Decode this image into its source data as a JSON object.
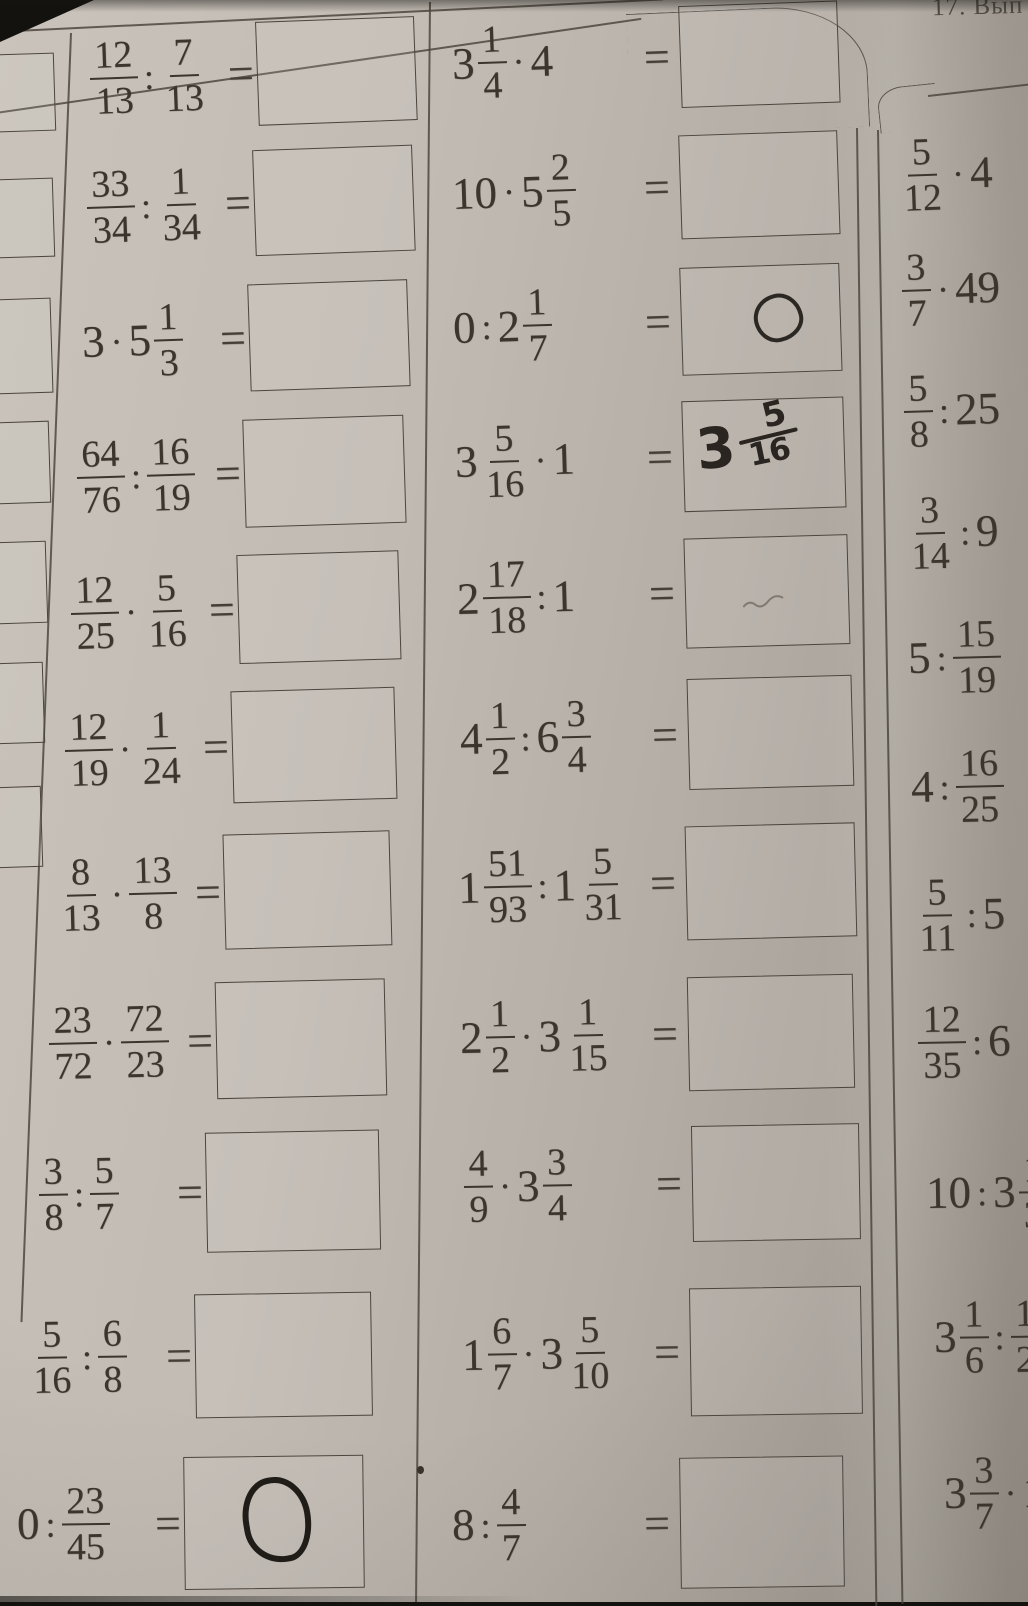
{
  "header": {
    "exercise_label": "17. Вып"
  },
  "ui": {
    "equals": "="
  },
  "left_margin": {
    "cutoff_answer_boxes": 7,
    "pencil_mark_in_box_index": 3
  },
  "problems": {
    "col1": [
      {
        "tokens": [
          {
            "t": "frac",
            "n": "12",
            "d": "13"
          },
          {
            "t": "op",
            "v": ":"
          },
          {
            "t": "frac",
            "n": "7",
            "d": "13"
          }
        ]
      },
      {
        "tokens": [
          {
            "t": "frac",
            "n": "33",
            "d": "34"
          },
          {
            "t": "op",
            "v": ":"
          },
          {
            "t": "frac",
            "n": "1",
            "d": "34"
          }
        ]
      },
      {
        "tokens": [
          {
            "t": "int",
            "v": "3"
          },
          {
            "t": "op",
            "v": "·"
          },
          {
            "t": "mix",
            "w": "5",
            "n": "1",
            "d": "3"
          }
        ]
      },
      {
        "tokens": [
          {
            "t": "frac",
            "n": "64",
            "d": "76"
          },
          {
            "t": "op",
            "v": ":"
          },
          {
            "t": "frac",
            "n": "16",
            "d": "19"
          }
        ]
      },
      {
        "tokens": [
          {
            "t": "frac",
            "n": "12",
            "d": "25"
          },
          {
            "t": "op",
            "v": "·"
          },
          {
            "t": "frac",
            "n": "5",
            "d": "16"
          }
        ]
      },
      {
        "tokens": [
          {
            "t": "frac",
            "n": "12",
            "d": "19"
          },
          {
            "t": "op",
            "v": "·"
          },
          {
            "t": "frac",
            "n": "1",
            "d": "24"
          }
        ]
      },
      {
        "tokens": [
          {
            "t": "frac",
            "n": "8",
            "d": "13"
          },
          {
            "t": "op",
            "v": "·"
          },
          {
            "t": "frac",
            "n": "13",
            "d": "8"
          }
        ]
      },
      {
        "tokens": [
          {
            "t": "frac",
            "n": "23",
            "d": "72"
          },
          {
            "t": "op",
            "v": "·"
          },
          {
            "t": "frac",
            "n": "72",
            "d": "23"
          }
        ]
      },
      {
        "tokens": [
          {
            "t": "frac",
            "n": "3",
            "d": "8"
          },
          {
            "t": "op",
            "v": ":"
          },
          {
            "t": "frac",
            "n": "5",
            "d": "7"
          }
        ]
      },
      {
        "tokens": [
          {
            "t": "frac",
            "n": "5",
            "d": "16"
          },
          {
            "t": "op",
            "v": ":"
          },
          {
            "t": "frac",
            "n": "6",
            "d": "8"
          }
        ]
      },
      {
        "tokens": [
          {
            "t": "int",
            "v": "0"
          },
          {
            "t": "op",
            "v": ":"
          },
          {
            "t": "frac",
            "n": "23",
            "d": "45"
          }
        ],
        "handwritten": {
          "kind": "bold-oval-zero",
          "value": "0"
        }
      }
    ],
    "col2": [
      {
        "tokens": [
          {
            "t": "mix",
            "w": "3",
            "n": "1",
            "d": "4"
          },
          {
            "t": "op",
            "v": "·"
          },
          {
            "t": "int",
            "v": "4"
          }
        ]
      },
      {
        "tokens": [
          {
            "t": "int",
            "v": "10"
          },
          {
            "t": "op",
            "v": "·"
          },
          {
            "t": "mix",
            "w": "5",
            "n": "2",
            "d": "5"
          }
        ]
      },
      {
        "tokens": [
          {
            "t": "int",
            "v": "0"
          },
          {
            "t": "op",
            "v": ":"
          },
          {
            "t": "mix",
            "w": "2",
            "n": "1",
            "d": "7"
          }
        ],
        "handwritten": {
          "kind": "oval-zero",
          "value": "0"
        }
      },
      {
        "tokens": [
          {
            "t": "mix",
            "w": "3",
            "n": "5",
            "d": "16"
          },
          {
            "t": "op",
            "v": "·"
          },
          {
            "t": "int",
            "v": "1"
          }
        ],
        "handwritten": {
          "kind": "mixed-number",
          "value": "3 5/16",
          "w": "3",
          "n": "5",
          "d": "16"
        }
      },
      {
        "tokens": [
          {
            "t": "mix",
            "w": "2",
            "n": "17",
            "d": "18"
          },
          {
            "t": "op",
            "v": ":"
          },
          {
            "t": "int",
            "v": "1"
          }
        ],
        "handwritten": {
          "kind": "faint-scribble"
        }
      },
      {
        "tokens": [
          {
            "t": "mix",
            "w": "4",
            "n": "1",
            "d": "2"
          },
          {
            "t": "op",
            "v": ":"
          },
          {
            "t": "mix",
            "w": "6",
            "n": "3",
            "d": "4"
          }
        ]
      },
      {
        "tokens": [
          {
            "t": "mix",
            "w": "1",
            "n": "51",
            "d": "93"
          },
          {
            "t": "op",
            "v": ":"
          },
          {
            "t": "mix",
            "w": "1",
            "n": "5",
            "d": "31"
          }
        ]
      },
      {
        "tokens": [
          {
            "t": "mix",
            "w": "2",
            "n": "1",
            "d": "2"
          },
          {
            "t": "op",
            "v": "·"
          },
          {
            "t": "mix",
            "w": "3",
            "n": "1",
            "d": "15"
          }
        ]
      },
      {
        "tokens": [
          {
            "t": "frac",
            "n": "4",
            "d": "9"
          },
          {
            "t": "op",
            "v": "·"
          },
          {
            "t": "mix",
            "w": "3",
            "n": "3",
            "d": "4"
          }
        ]
      },
      {
        "tokens": [
          {
            "t": "mix",
            "w": "1",
            "n": "6",
            "d": "7"
          },
          {
            "t": "op",
            "v": "·"
          },
          {
            "t": "mix",
            "w": "3",
            "n": "5",
            "d": "10"
          }
        ]
      },
      {
        "tokens": [
          {
            "t": "int",
            "v": "8"
          },
          {
            "t": "op",
            "v": ":"
          },
          {
            "t": "frac",
            "n": "4",
            "d": "7"
          }
        ]
      }
    ],
    "col3": [
      {
        "tokens": [
          {
            "t": "frac",
            "n": "5",
            "d": "12"
          },
          {
            "t": "op",
            "v": "·"
          },
          {
            "t": "int",
            "v": "4"
          }
        ]
      },
      {
        "tokens": [
          {
            "t": "frac",
            "n": "3",
            "d": "7"
          },
          {
            "t": "op",
            "v": "·"
          },
          {
            "t": "int",
            "v": "49"
          }
        ]
      },
      {
        "tokens": [
          {
            "t": "frac",
            "n": "5",
            "d": "8"
          },
          {
            "t": "op",
            "v": ":"
          },
          {
            "t": "int",
            "v": "25"
          }
        ]
      },
      {
        "tokens": [
          {
            "t": "frac",
            "n": "3",
            "d": "14"
          },
          {
            "t": "op",
            "v": ":"
          },
          {
            "t": "int",
            "v": "9"
          }
        ]
      },
      {
        "tokens": [
          {
            "t": "int",
            "v": "5"
          },
          {
            "t": "op",
            "v": ":"
          },
          {
            "t": "frac",
            "n": "15",
            "d": "19"
          }
        ]
      },
      {
        "tokens": [
          {
            "t": "int",
            "v": "4"
          },
          {
            "t": "op",
            "v": ":"
          },
          {
            "t": "frac",
            "n": "16",
            "d": "25"
          }
        ]
      },
      {
        "tokens": [
          {
            "t": "frac",
            "n": "5",
            "d": "11"
          },
          {
            "t": "op",
            "v": ":"
          },
          {
            "t": "int",
            "v": "5"
          }
        ]
      },
      {
        "tokens": [
          {
            "t": "frac",
            "n": "12",
            "d": "35"
          },
          {
            "t": "op",
            "v": ":"
          },
          {
            "t": "int",
            "v": "6"
          }
        ]
      },
      {
        "tokens": [
          {
            "t": "int",
            "v": "10"
          },
          {
            "t": "op",
            "v": ":"
          },
          {
            "t": "mix",
            "w": "3",
            "n": "1",
            "d": "3"
          }
        ]
      },
      {
        "tokens": [
          {
            "t": "mix",
            "w": "3",
            "n": "1",
            "d": "6"
          },
          {
            "t": "op",
            "v": ":"
          },
          {
            "t": "frac",
            "n": "1",
            "d": "2"
          }
        ]
      },
      {
        "tokens": [
          {
            "t": "mix",
            "w": "3",
            "n": "3",
            "d": "7"
          },
          {
            "t": "op",
            "v": "·"
          },
          {
            "t": "int",
            "v": "1"
          }
        ]
      }
    ]
  }
}
